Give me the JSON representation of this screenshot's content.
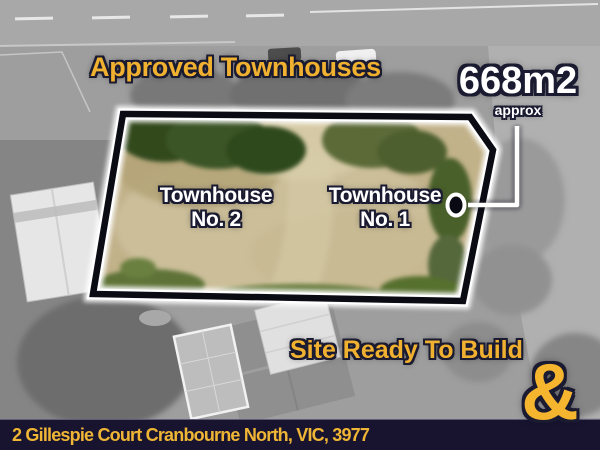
{
  "overlays": {
    "approved_label": "Approved Townhouses",
    "area_value": "668m2",
    "area_qualifier": "approx",
    "townhouse_2_line1": "Townhouse",
    "townhouse_2_line2": "No. 2",
    "townhouse_1_line1": "Townhouse",
    "townhouse_1_line2": "No. 1",
    "site_ready_label": "Site Ready To Build"
  },
  "footer": {
    "address": "2 Gillespie Court Cranbourne North, VIC, 3977"
  },
  "branding": {
    "ampersand": "&"
  },
  "map": {
    "lot_area_sqm": "668m2",
    "lot_units": [
      "Townhouse No. 2",
      "Townhouse No. 1"
    ],
    "marker": "lot-boundary-callout-dot"
  },
  "colors": {
    "accent_yellow": "#F0B030",
    "label_white": "#FFFFFF",
    "outline_navy": "#1A1A30",
    "footer_bg": "#181430",
    "boundary_line": "#0B0B14",
    "boundary_glow": "#FFFFFF",
    "lot_grass_tan": "#C2B28A",
    "lot_hedge_green": "#3A5526"
  }
}
